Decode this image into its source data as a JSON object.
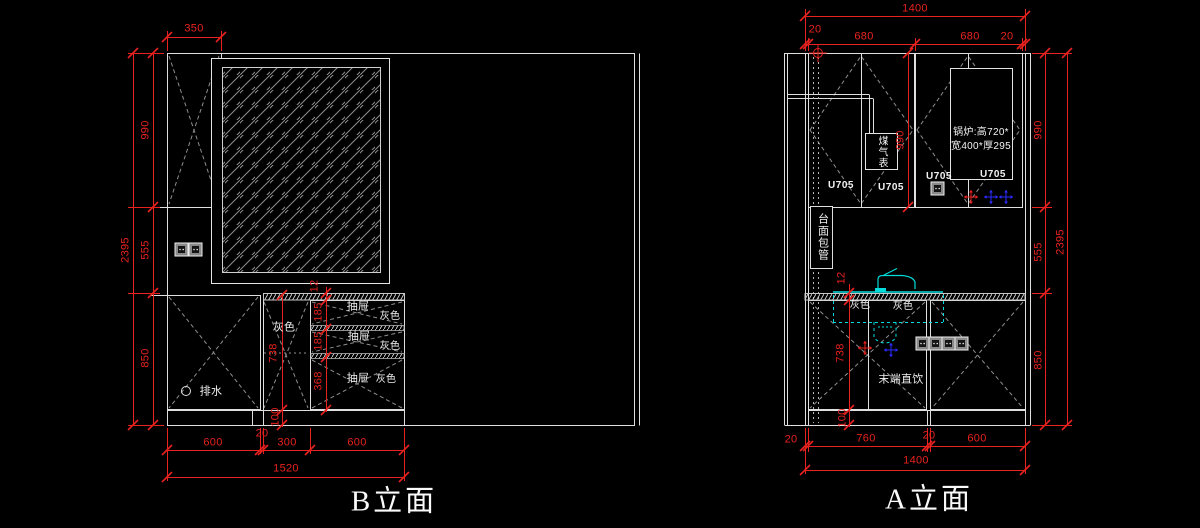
{
  "colors": {
    "background": "#000000",
    "drawing_line": "#dfdfdf",
    "dimension": "#e8221e",
    "plumbing_cyan": "#00dcdc",
    "water_point_blue": "#2b2bff",
    "hatch_gray": "#8f8f8f"
  },
  "b": {
    "title": "B立面",
    "dim_top": "350",
    "dim_total_h": "2395",
    "dim_h": [
      "990",
      "555",
      "850"
    ],
    "dim_counter": "12",
    "dim_drawers": [
      "185",
      "185",
      "368"
    ],
    "dim_carcass": "738",
    "dim_kick": "100",
    "dim_bottom": [
      "600",
      "20",
      "300",
      "600"
    ],
    "dim_total_w": "1520",
    "lbl_gray": "灰色",
    "lbl_drain": "排水",
    "drawers": [
      {
        "n": "抽屉",
        "c": "灰色"
      },
      {
        "n": "抽屉",
        "c": "灰色"
      },
      {
        "n": "抽屉",
        "c": "灰色"
      }
    ]
  },
  "a": {
    "title": "A立面",
    "dim_total_w_top": "1400",
    "dim_top": [
      "20",
      "680",
      "680",
      "20"
    ],
    "dim_mid_h": "990",
    "dim_total_h": "2395",
    "dim_h": [
      "990",
      "555",
      "850"
    ],
    "dim_counter": "12",
    "dim_carcass": "738",
    "dim_kick": "100",
    "dim_bottom": [
      "20",
      "760",
      "20",
      "600"
    ],
    "dim_total_w": "1400",
    "lbl_meter": "煤气表",
    "u705": [
      "U705",
      "U705",
      "U705",
      "U705"
    ],
    "boiler1": "锅炉:高720*",
    "boiler2": "宽400*厚295",
    "lbl_pipe": "台面包管",
    "lbl_gray1": "灰色",
    "lbl_gray2": "灰色",
    "lbl_water": "末端直饮"
  }
}
